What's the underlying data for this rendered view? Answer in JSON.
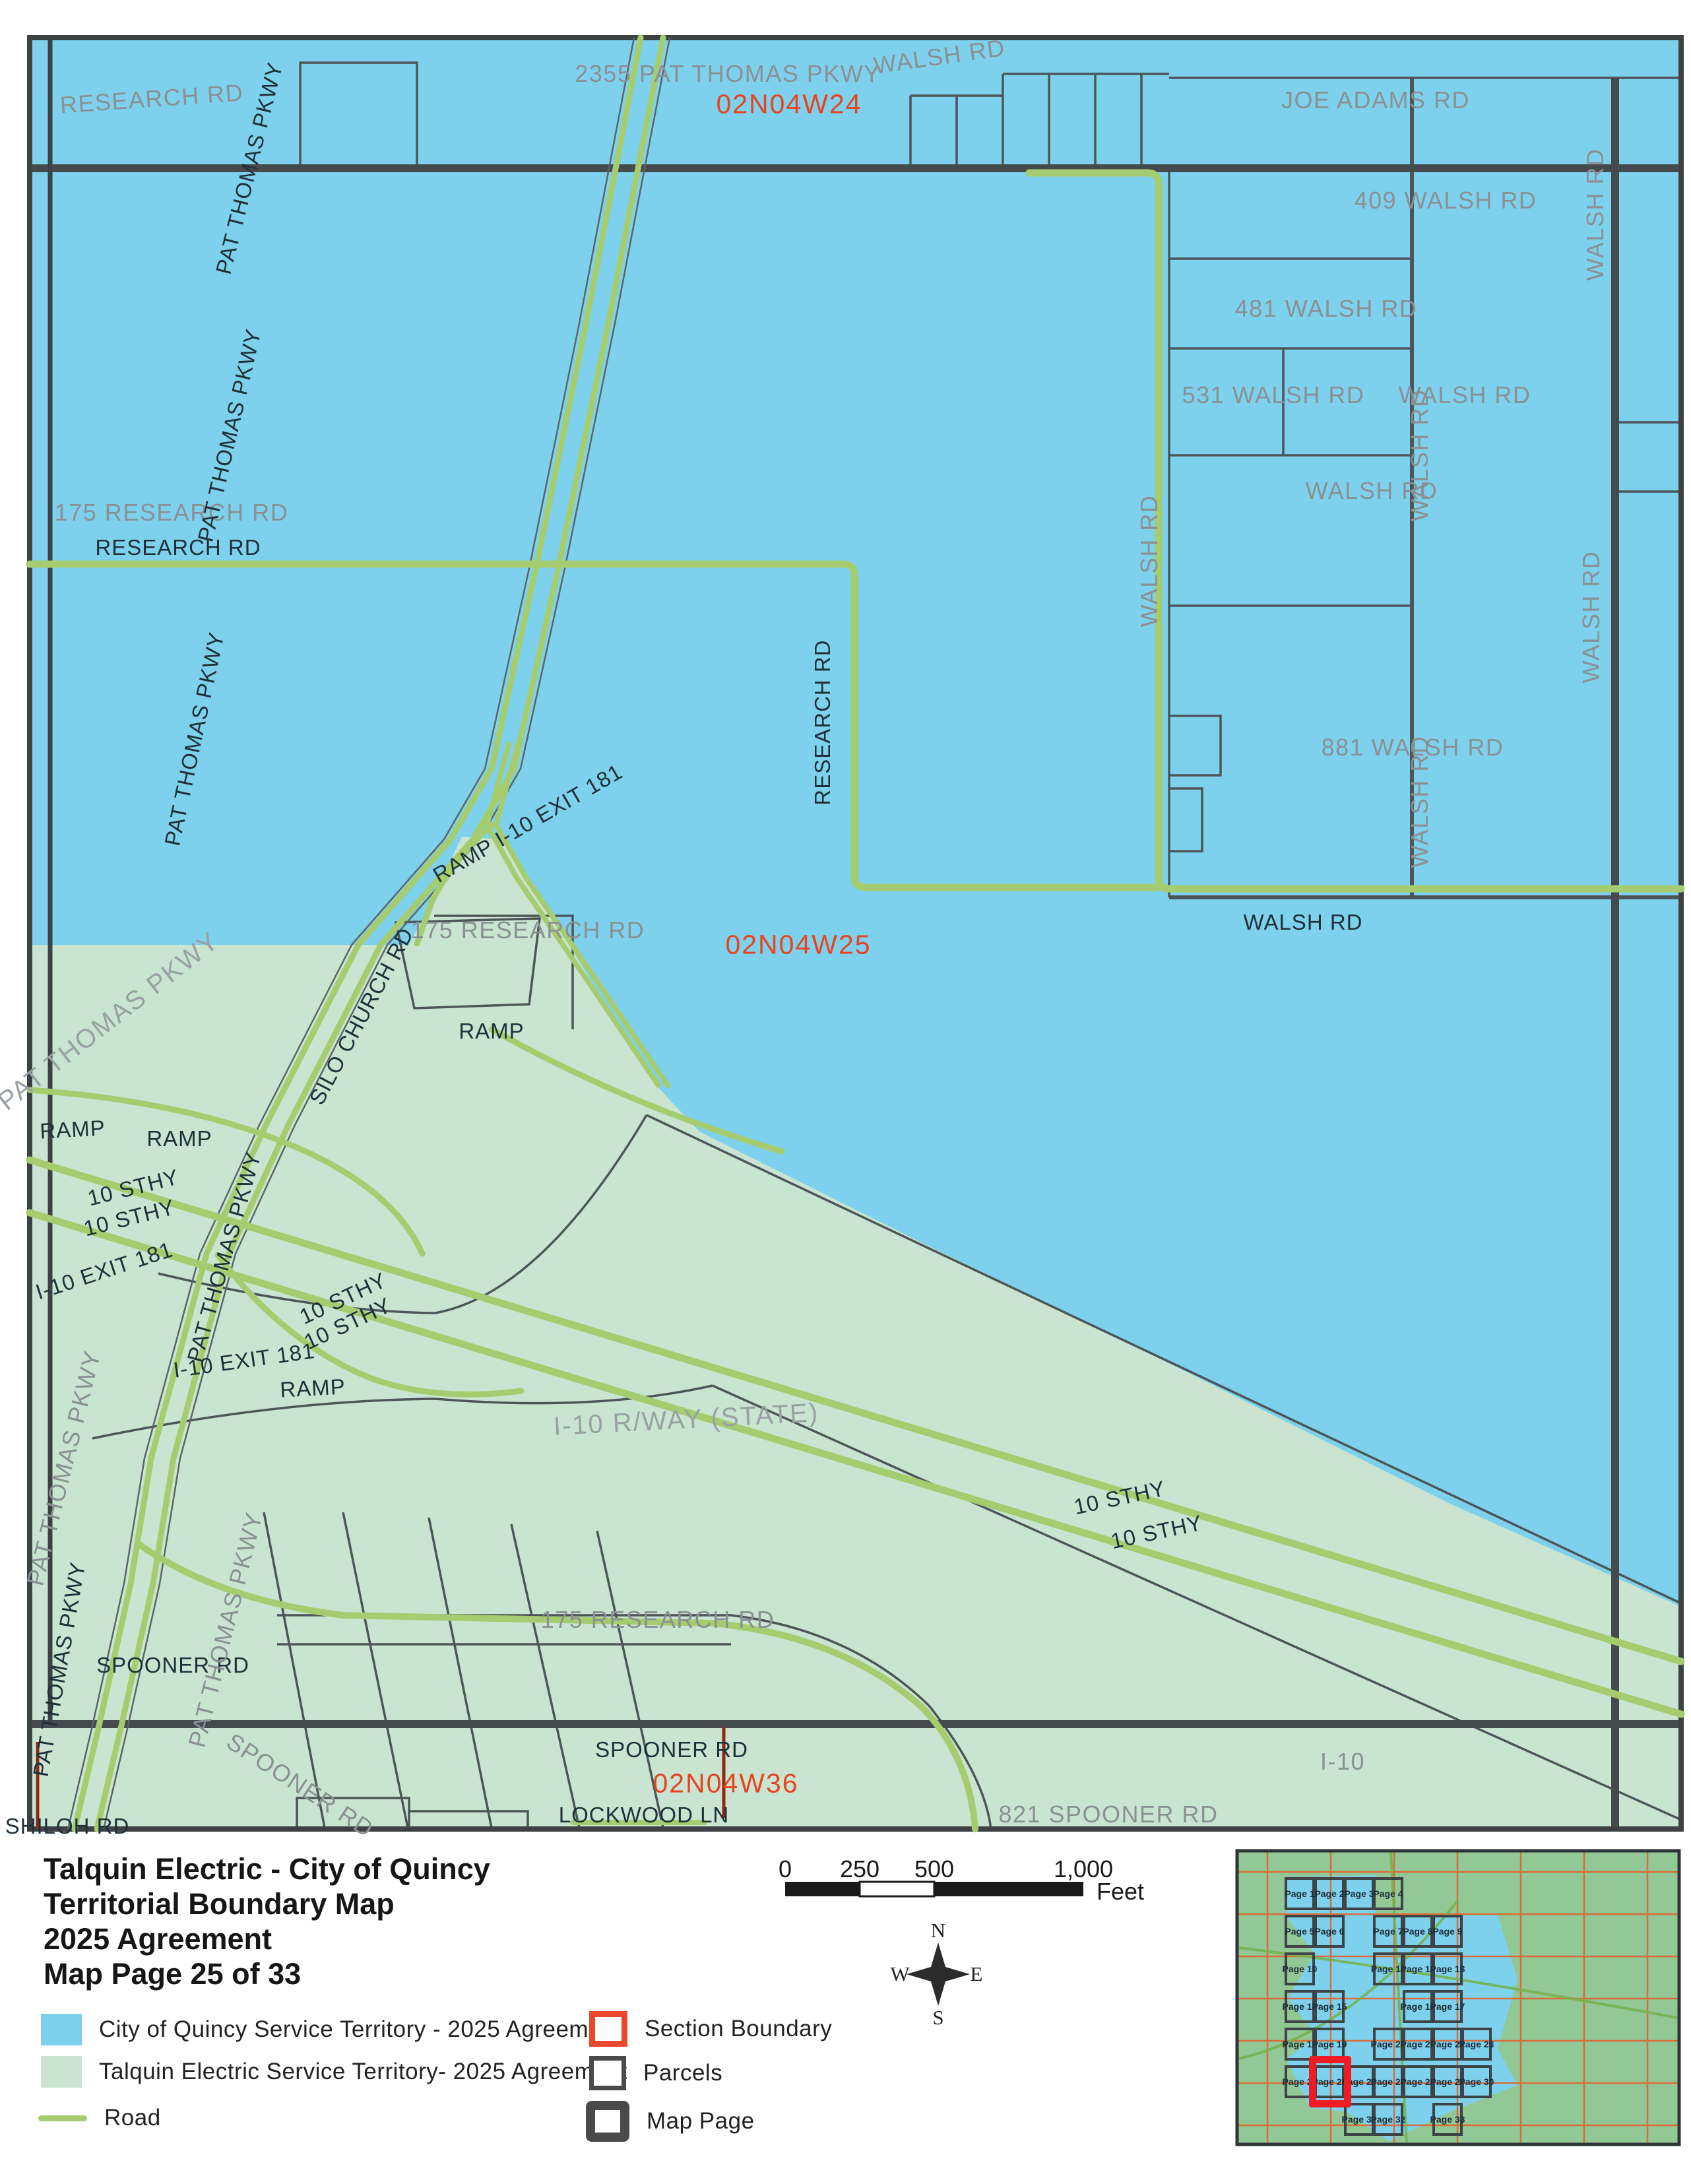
{
  "title_block": {
    "line1": "Talquin Electric - City of Quincy",
    "line2": "Territorial Boundary Map",
    "line3": "2025 Agreement",
    "line4": "Map Page 25 of 33"
  },
  "legend": {
    "items": [
      {
        "label": "City of Quincy Service Territory - 2025 Agreement"
      },
      {
        "label": "Talquin Electric Service Territory- 2025 Agreement"
      },
      {
        "label": "Road"
      },
      {
        "label": "Section Boundary"
      },
      {
        "label": "Parcels"
      },
      {
        "label": "Map Page"
      }
    ]
  },
  "scale_bar": {
    "ticks": [
      "0",
      "250",
      "500",
      "1,000"
    ],
    "unit": "Feet"
  },
  "compass": {
    "n": "N",
    "s": "S",
    "e": "E",
    "w": "W"
  },
  "colors": {
    "quincy_blue": "#7ed1ec",
    "talquin_green": "#c9e5d2",
    "road_green": "#a5cd6f",
    "section_label_red": "#e8441f",
    "section_line_red": "#8f2616",
    "inset_highlight_red": "#ee1c24",
    "parcel_gray": "#4d5558"
  },
  "map": {
    "labels": [
      {
        "text": "RESEARCH RD"
      },
      {
        "text": "2355 PAT THOMAS PKWY"
      },
      {
        "text": "WALSH RD"
      },
      {
        "text": "02N04W24"
      },
      {
        "text": "JOE ADAMS RD"
      },
      {
        "text": "409 WALSH RD"
      },
      {
        "text": "481 WALSH RD"
      },
      {
        "text": "531 WALSH RD"
      },
      {
        "text": "WALSH RD"
      },
      {
        "text": "WALSH RD"
      },
      {
        "text": "175 RESEARCH RD"
      },
      {
        "text": "RESEARCH RD"
      },
      {
        "text": "881 WALSH RD"
      },
      {
        "text": "WALSH RD"
      },
      {
        "text": "RESEARCH RD"
      },
      {
        "text": "WALSH RD"
      },
      {
        "text": "WALSH RD"
      },
      {
        "text": "WALSH RD"
      },
      {
        "text": "WALSH RD"
      },
      {
        "text": "175 RESEARCH RD"
      },
      {
        "text": "02N04W25"
      },
      {
        "text": "WALSH RD"
      },
      {
        "text": "PAT THOMAS PKWY"
      },
      {
        "text": "PAT THOMAS PKWY"
      },
      {
        "text": "PAT THOMAS PKWY"
      },
      {
        "text": "PAT THOMAS PKWY"
      },
      {
        "text": "SILO CHURCH RD"
      },
      {
        "text": "RAMP"
      },
      {
        "text": "RAMP"
      },
      {
        "text": "10 STHY"
      },
      {
        "text": "10 STHY"
      },
      {
        "text": "I-10 EXIT 181"
      },
      {
        "text": "PAT THOMAS PKWY"
      },
      {
        "text": "RAMP I-10 EXIT 181"
      },
      {
        "text": "RAMP"
      },
      {
        "text": "10 STHY"
      },
      {
        "text": "10 STHY"
      },
      {
        "text": "I-10 EXIT 181"
      },
      {
        "text": "RAMP"
      },
      {
        "text": "I-10 R/WAY (STATE)"
      },
      {
        "text": "10 STHY"
      },
      {
        "text": "10 STHY"
      },
      {
        "text": "PAT THOMAS PKWY"
      },
      {
        "text": "175 RESEARCH RD"
      },
      {
        "text": "SPOONER RD"
      },
      {
        "text": "PAT THOMAS PKWY"
      },
      {
        "text": "SPOONER RD"
      },
      {
        "text": "02N04W36"
      },
      {
        "text": "SPOONER RD"
      },
      {
        "text": "LOCKWOOD LN"
      },
      {
        "text": "821 SPOONER RD"
      },
      {
        "text": "I-10"
      },
      {
        "text": "SHILOH RD"
      },
      {
        "text": "PAT THOMAS PKWY"
      }
    ]
  },
  "inset": {
    "highlighted_page": "Page 25",
    "pages": [
      {
        "label": "Page 1"
      },
      {
        "label": "Page 2"
      },
      {
        "label": "Page 3"
      },
      {
        "label": "Page 4"
      },
      {
        "label": "Page 5"
      },
      {
        "label": "Page 6"
      },
      {
        "label": "Page 7"
      },
      {
        "label": "Page 8"
      },
      {
        "label": "Page 9"
      },
      {
        "label": "Page 10"
      },
      {
        "label": "Page 11"
      },
      {
        "label": "Page 12"
      },
      {
        "label": "Page 13"
      },
      {
        "label": "Page 14"
      },
      {
        "label": "Page 15"
      },
      {
        "label": "Page 16"
      },
      {
        "label": "Page 17"
      },
      {
        "label": "Page 18"
      },
      {
        "label": "Page 19"
      },
      {
        "label": "Page 20"
      },
      {
        "label": "Page 21"
      },
      {
        "label": "Page 22"
      },
      {
        "label": "Page 23"
      },
      {
        "label": "Page 24"
      },
      {
        "label": "Page 25"
      },
      {
        "label": "Page 26"
      },
      {
        "label": "Page 27"
      },
      {
        "label": "Page 28"
      },
      {
        "label": "Page 29"
      },
      {
        "label": "Page 30"
      },
      {
        "label": "Page 31"
      },
      {
        "label": "Page 32"
      },
      {
        "label": "Page 33"
      }
    ]
  }
}
